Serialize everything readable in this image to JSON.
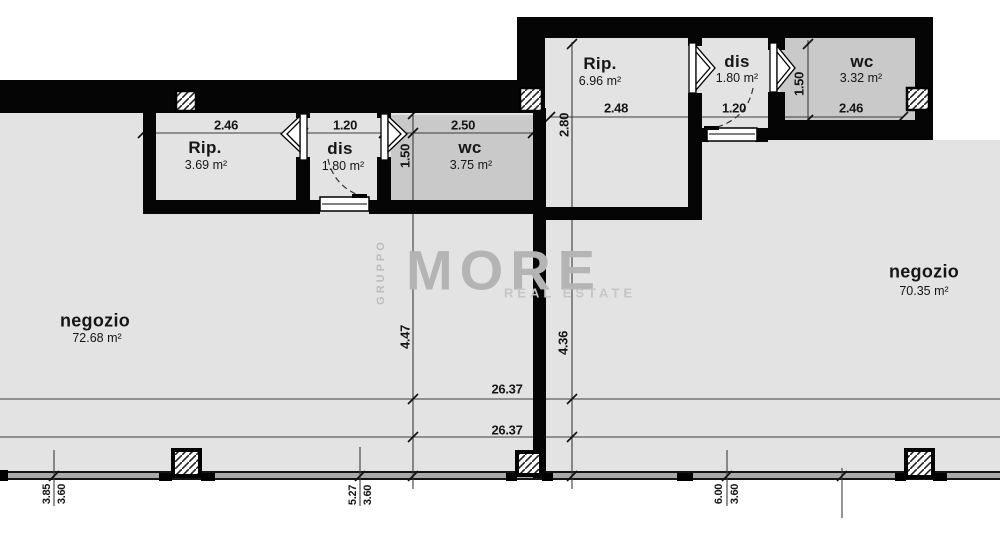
{
  "watermark": {
    "group": "GRUPPO",
    "brand": "MORE",
    "tagline": "REAL ESTATE"
  },
  "overall": {
    "width_dim_a": "26.37",
    "width_dim_b": "26.37"
  },
  "left_unit": {
    "dim_top_rip": "2.46",
    "dim_top_dis": "1.20",
    "dim_top_wc": "2.50",
    "rip_name": "Rip.",
    "rip_area": "3.69 m²",
    "dis_name": "dis",
    "dis_area": "1.80 m²",
    "wc_name": "wc",
    "wc_area": "3.75 m²",
    "wc_depth_dim": "1.50",
    "negozio_name": "negozio",
    "negozio_area": "72.68 m²",
    "depth_dim": "4.47",
    "front_dim_1a": "3.85",
    "front_dim_1b": "3.60",
    "front_dim_2a": "5.27",
    "front_dim_2b": "3.60"
  },
  "right_unit": {
    "rip_name": "Rip.",
    "rip_area": "6.96 m²",
    "rip_width_dim": "2.48",
    "rip_depth_dim": "2.80",
    "dis_name": "dis",
    "dis_area": "1.80 m²",
    "dis_width_dim": "1.20",
    "wc_name": "wc",
    "wc_area": "3.32 m²",
    "wc_width_dim": "2.46",
    "wc_depth_dim": "1.50",
    "negozio_name": "negozio",
    "negozio_area": "70.35 m²",
    "depth_dim": "4.36",
    "front_dim_1a": "6.00",
    "front_dim_1b": "3.60"
  },
  "colors": {
    "wall": "#050505",
    "floor": "#e3e3e3",
    "wet_room_floor": "#c9c9c9",
    "storefront_band": "#a9a9a9",
    "dimension_line": "#3c3c3c",
    "watermark": "#b4b4b4"
  }
}
